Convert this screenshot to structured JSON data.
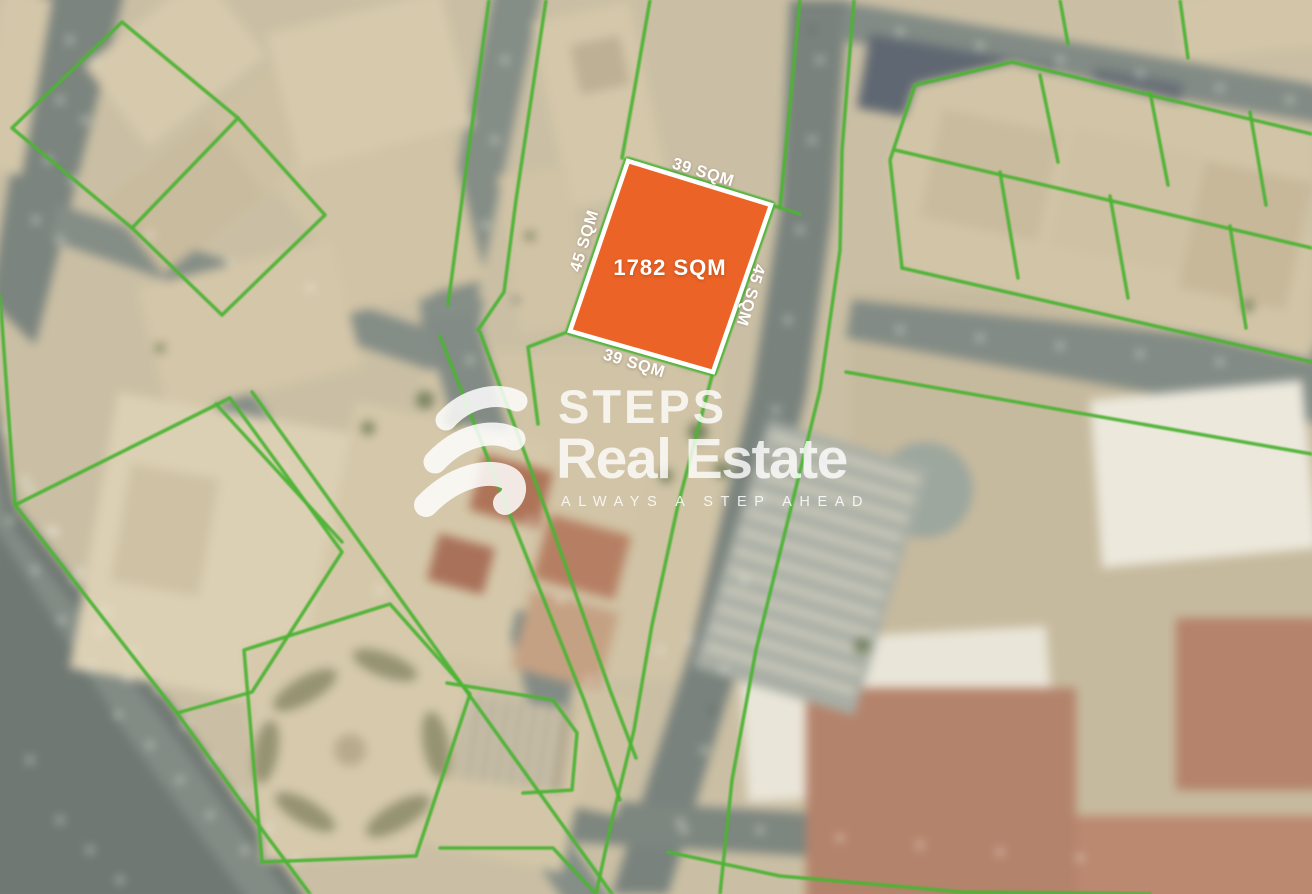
{
  "plot": {
    "area_label": "1782 SQM",
    "top_edge_label": "39 SQM",
    "bottom_edge_label": "39 SQM",
    "left_edge_label": "45 SQM",
    "right_edge_label": "45 SQM",
    "fill_color": "#EB6326",
    "border_color": "#FFFFFF"
  },
  "map": {
    "parcel_line_color": "#4DB335"
  },
  "watermark": {
    "brand_line1": "STEPS",
    "brand_line2": "Real Estate",
    "tagline": "ALWAYS A STEP AHEAD"
  }
}
